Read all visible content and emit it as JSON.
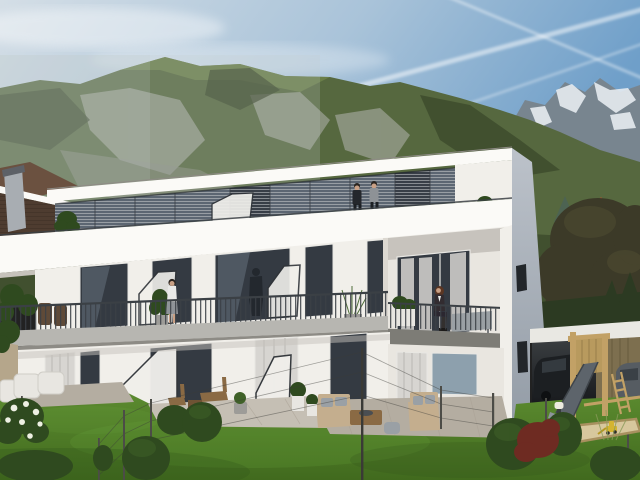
{
  "scene": {
    "type": "architectural exterior rendering",
    "time_of_day": "day",
    "description": "Modern flat-roofed three-storey white apartment building with continuous balconies and glass privacy screens, set in an Alpine valley with forested mountains and snow-capped peaks; landscaped garden with lawn, paved terraces, outdoor furniture, wooden play tower with metal slide, sandbox with toy digger, carport with parked cars and a neighbouring gabled-roof house at left",
    "building": {
      "storeys": 3,
      "style": "modern white render, flat roof, recessed right bay",
      "balconies": "full-width steel rod railings with angled glass privacy screens"
    },
    "figures": {
      "roof_terrace": "two men standing at the roof terrace parapet",
      "middle_balcony": "woman standing at balcony railing beside a potted plant",
      "right_balcony": "seated woman with long red-brown hair on recessed corner balcony",
      "glass_reflection": "dark silhouette reflected in balcony glazing"
    },
    "garden": [
      "lawn",
      "white garden chairs",
      "flowering shrub",
      "wooden bistro chairs",
      "beige lounge sofas with grey cushions",
      "wooden coffee table with bowl",
      "topiary pots",
      "wire fence with thin posts",
      "burgundy shrub",
      "bollard light",
      "play tower with slide and ladder",
      "sandbox with yellow toy digger",
      "carport with dark SUV and grey car"
    ]
  },
  "colors": {
    "sky_left": "#d4dee6",
    "sky_mid": "#a9c3d9",
    "sky_right": "#6f9fc9",
    "cloud": "#ffffff",
    "contrail": "#ffffff",
    "ridge_green": "#56683f",
    "ridge_light": "#74874e",
    "ridge_dark": "#394629",
    "scree": "#9ba092",
    "rock_low": "#8b8e83",
    "haze": "#c2ccce",
    "snow_rock": "#78858f",
    "snow": "#e9eef3",
    "tree_leafy": "#3c3a28",
    "tree_leafy_light": "#4e4b31",
    "spruce": "#4d6352",
    "conifer": "#2c3a22",
    "distant_wall": "#d9dad4",
    "turret_roof": "#b04f2c",
    "turret_wall": "#c8b474",
    "nb_roof": "#4e3c30",
    "nb_roof_up": "#6b5140",
    "nb_roof_dark": "#3b2d24",
    "chimney": "#a8adb2",
    "chimney_cap": "#5d6167",
    "fascia": "#fbfaf7",
    "facade": "#f1efea",
    "facade_shade": "#dcd8d1",
    "recess_white": "#e9e6e0",
    "soffit": "#c7c3bd",
    "band_shadow": "#c6c2bb",
    "side_wall_top": "#bcc2ca",
    "side_wall_bot": "#939ca6",
    "side_window": "#22262a",
    "glass_dark": "#343a42",
    "glass_mid": "#5c6672",
    "glass_sky": "#8da0ad",
    "frame_white": "#e8e7e3",
    "blind": "#c9ccce",
    "curtain": "#d7d5d1",
    "curtain_dark": "#b9b7b3",
    "railing": "#3b4045",
    "slab": "#b7b6b1",
    "slab_dark": "#7d7c76",
    "slab_shadow": "#8d8b85",
    "screen_fill": "#f0efeb",
    "screen_frame": "#303439",
    "lawn_top": "#5e8e31",
    "lawn_bot": "#416a1e",
    "lawn_light": "#6ba33c",
    "lawn_dark": "#33551b",
    "paver": "#b4ada1",
    "paver_light": "#c5bfb4",
    "paver_line": "#a79f92",
    "bush": "#2f4a1f",
    "bush_light": "#3f6128",
    "bush_red": "#6e2b22",
    "flower": "#eef0e3",
    "wood": "#8a6a44",
    "wood_dark": "#6e5334",
    "sofa": "#c4ae8e",
    "cushion": "#9aa0a5",
    "pot_white": "#e8e6e1",
    "pot_grey": "#9d9c98",
    "play_wood": "#c2a166",
    "slat_wood": "#b89a5e",
    "slide": "#5d646b",
    "slide_light": "#8d949b",
    "carport_white": "#e9e8e3",
    "carport_top": "#3b3f42",
    "carport_bot": "#17191c",
    "shed_wood": "#7d6f4f",
    "suv": "#1c1f22",
    "car_grey": "#565c62",
    "sand": "#d7c79d",
    "sand_frame": "#a8905f",
    "digger": "#d4b431",
    "fence": "#4c4c47",
    "wire": "#3c3c38",
    "bollard": "#3a3d40",
    "bollard_cap": "#edebdf",
    "tan_wall": "#b5a68b",
    "skin": "#c9a085",
    "hair_dark": "#2a241f",
    "hair_red": "#5a3522",
    "suit": "#24272c",
    "jacket_grey": "#8e9296",
    "shirt_white": "#e9e9e7",
    "skirt": "#8f9398",
    "woman_jacket": "#322c30",
    "reflection": "#1f242a",
    "bench": "#9aa0a4",
    "pants_dark": "#1d2024"
  }
}
